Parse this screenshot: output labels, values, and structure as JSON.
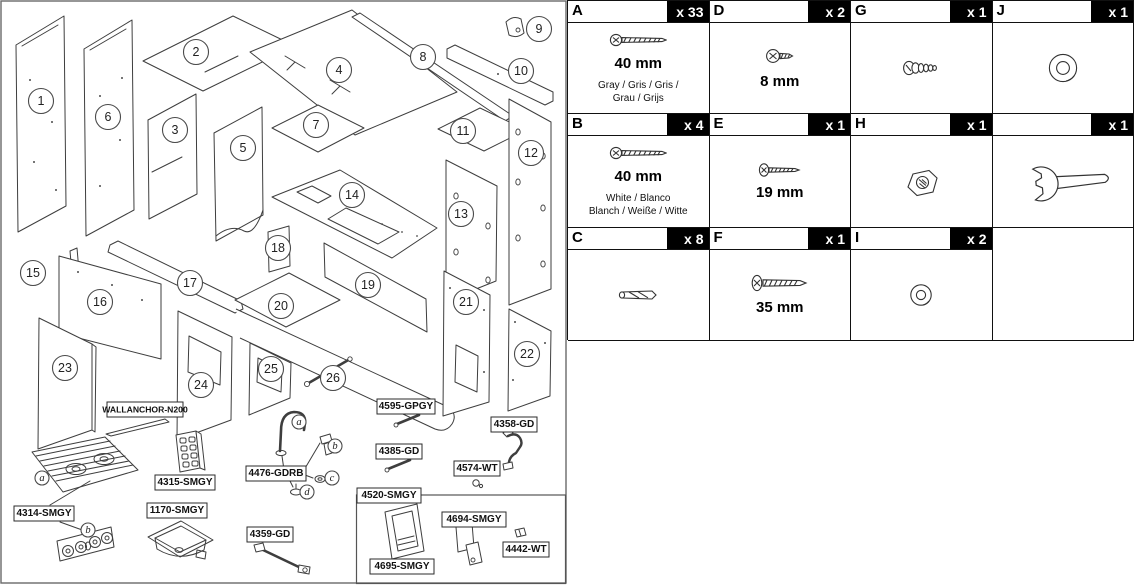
{
  "colors": {
    "line": "#3e3e3e",
    "border": "#111111",
    "badge_bg": "#000000",
    "badge_text": "#ffffff"
  },
  "diagram": {
    "numbered_parts": [
      "1",
      "2",
      "3",
      "4",
      "5",
      "6",
      "7",
      "8",
      "9",
      "10",
      "11",
      "12",
      "13",
      "14",
      "15",
      "16",
      "17",
      "18",
      "19",
      "20",
      "21",
      "22",
      "23",
      "24",
      "25",
      "26"
    ],
    "stove_callouts": [
      "a",
      "b"
    ],
    "faucet_callouts": [
      "a",
      "b",
      "c",
      "d"
    ],
    "part_labels": [
      "WALLANCHOR-N200",
      "4595-GPGY",
      "4358-GD",
      "4385-GD",
      "4574-WT",
      "4476-GDRB",
      "4315-SMGY",
      "4314-SMGY",
      "1170-SMGY",
      "4359-GD",
      "4520-SMGY",
      "4694-SMGY",
      "4695-SMGY",
      "4442-WT"
    ]
  },
  "hardware_table": {
    "cells": [
      {
        "letter": "A",
        "qty": "x 33",
        "size": "40 mm",
        "note": "Gray / Gris / Gris /\nGrau / Grijs",
        "icon": "long-screw-icon"
      },
      {
        "letter": "D",
        "qty": "x 2",
        "size": "8 mm",
        "note": "",
        "icon": "short-screw-icon"
      },
      {
        "letter": "G",
        "qty": "x 1",
        "size": "",
        "note": "",
        "icon": "threaded-fitting-icon"
      },
      {
        "letter": "J",
        "qty": "x 1",
        "size": "",
        "note": "",
        "icon": "large-washer-icon"
      },
      {
        "letter": "B",
        "qty": "x 4",
        "size": "40 mm",
        "note": "White / Blanco\nBlanch / Weiße / Witte",
        "icon": "long-screw-icon"
      },
      {
        "letter": "E",
        "qty": "x 1",
        "size": "19 mm",
        "note": "",
        "icon": "medium-screw-icon"
      },
      {
        "letter": "H",
        "qty": "x 1",
        "size": "",
        "note": "",
        "icon": "hex-nut-icon"
      },
      {
        "letter": "",
        "qty": "x 1",
        "size": "",
        "note": "",
        "icon": "wrench-icon"
      },
      {
        "letter": "C",
        "qty": "x 8",
        "size": "",
        "note": "",
        "icon": "wood-dowel-icon"
      },
      {
        "letter": "F",
        "qty": "x 1",
        "size": "35 mm",
        "note": "",
        "icon": "thick-screw-icon"
      },
      {
        "letter": "I",
        "qty": "x 2",
        "size": "",
        "note": "",
        "icon": "small-washer-icon"
      },
      {
        "letter": null,
        "qty": "",
        "size": "",
        "note": "",
        "icon": ""
      }
    ]
  }
}
